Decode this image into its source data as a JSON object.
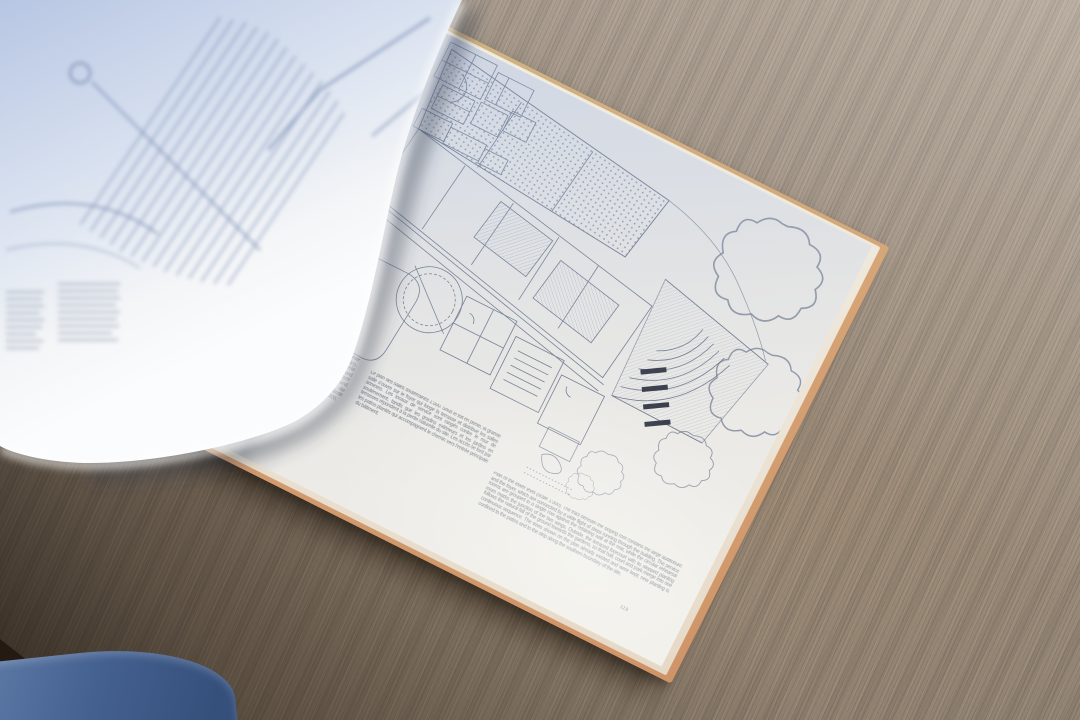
{
  "scene": {
    "setting": "open architecture book lying on an oak table, left page caught mid-turn and motion-blurred",
    "photo_style": "natural daylight photograph"
  },
  "book": {
    "cover_color": "#cf9b70",
    "right_page": {
      "figure": "ground-floor plan of a hall building with raked auditorium seating, round rehearsal room, terraced forecourt and trees",
      "captions": {
        "german": "Das grosse Auditorium liegt unter dem geneigten Dach des Saaltrakts. Die Nebenräume sind in einer Zeile entlang der Halle angeordnet und werden über das tieferliegende Foyer erschlossen. Garderoben und Technik liegen am Hang, die Terrassen folgen dem Gelände gegen den Garten. Massstab 1:300.",
        "french": "Le plan des salles souterraines 1:300. Sous le toit en pente, la grande salle s'ouvre sur le foyer qui longe la terrasse et distribue les salles annexes. Les locaux de service sont rangés contre le mur de soutènement, tandis que les gradins extérieurs et les jardins en terrasses répondent à la pente naturelle du site. Les accès se font par les patios plantés qui accompagnent le chemin vers l'entrée principale du bâtiment.",
        "english": "Plan of the lower level (scale 1:300). The tract beneath the sloping roof contains the large auditorium and the foyer, which are connected by a wide flight of steps running through the building. The service rooms are grouped in a single row against the retaining wall at the rear, while the circular rehearsal room marks the junction of the two wings. Outside, the terraced forecourt with its stepped planting follows the natural fall of the ground towards the gardens, so that hall, court and park merge into one continuous sequence. The trees shown on the plan already existed and were kept; new planting is confined to the patios and to the strip along the southern boundary of the site."
      },
      "page_number": "119"
    },
    "turning_page": {
      "content": "out-of-focus floor plan with long rows of seating and two small text columns"
    }
  },
  "colors": {
    "table_light": "#a29584",
    "table_dark": "#3c2f24",
    "paper": "#e9e7e3",
    "paper_blue_cast": "#c9d5ea",
    "plan_ink": "#5f6b82",
    "cover_edge": "#d09c70",
    "denim": "#44608f"
  }
}
